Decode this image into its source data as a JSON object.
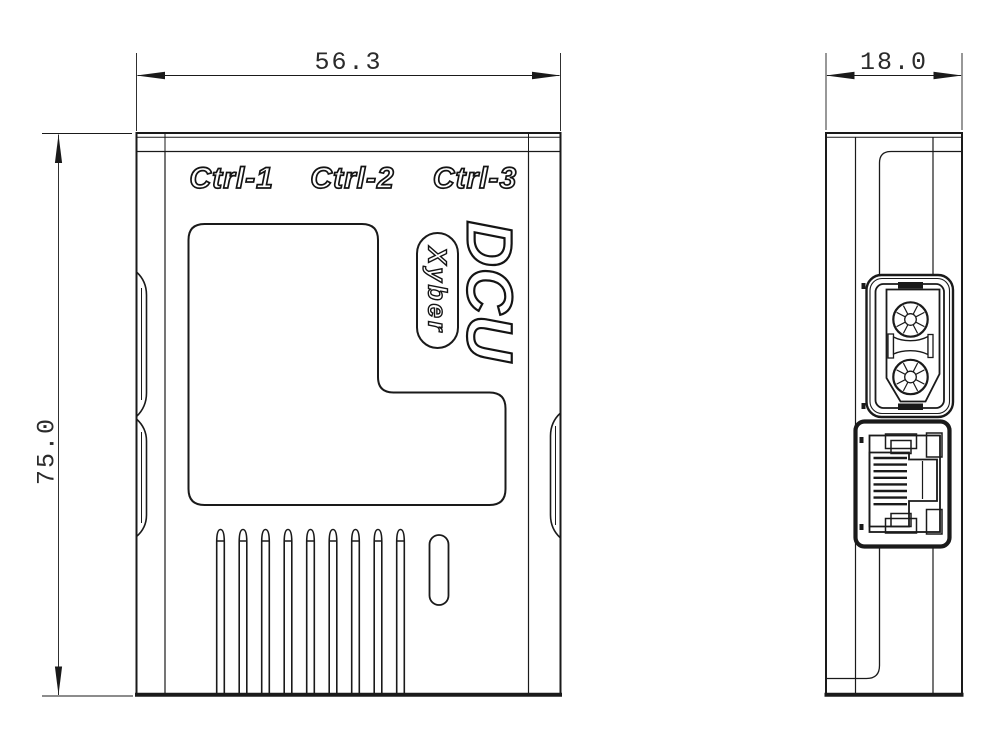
{
  "front_view": {
    "port_labels": [
      "Ctrl-1",
      "Ctrl-2",
      "Ctrl-3"
    ],
    "product_name": "DCU",
    "brand_badge": "Xyber",
    "width_dim": "56.3",
    "height_dim": "75.0",
    "vent_slot_count": 9
  },
  "side_view": {
    "depth_dim": "18.0",
    "top_connector": "xt30-power-connector",
    "bottom_connector": "rj45-jack"
  },
  "colors": {
    "line": "#1a1a1a",
    "background": "#ffffff"
  }
}
